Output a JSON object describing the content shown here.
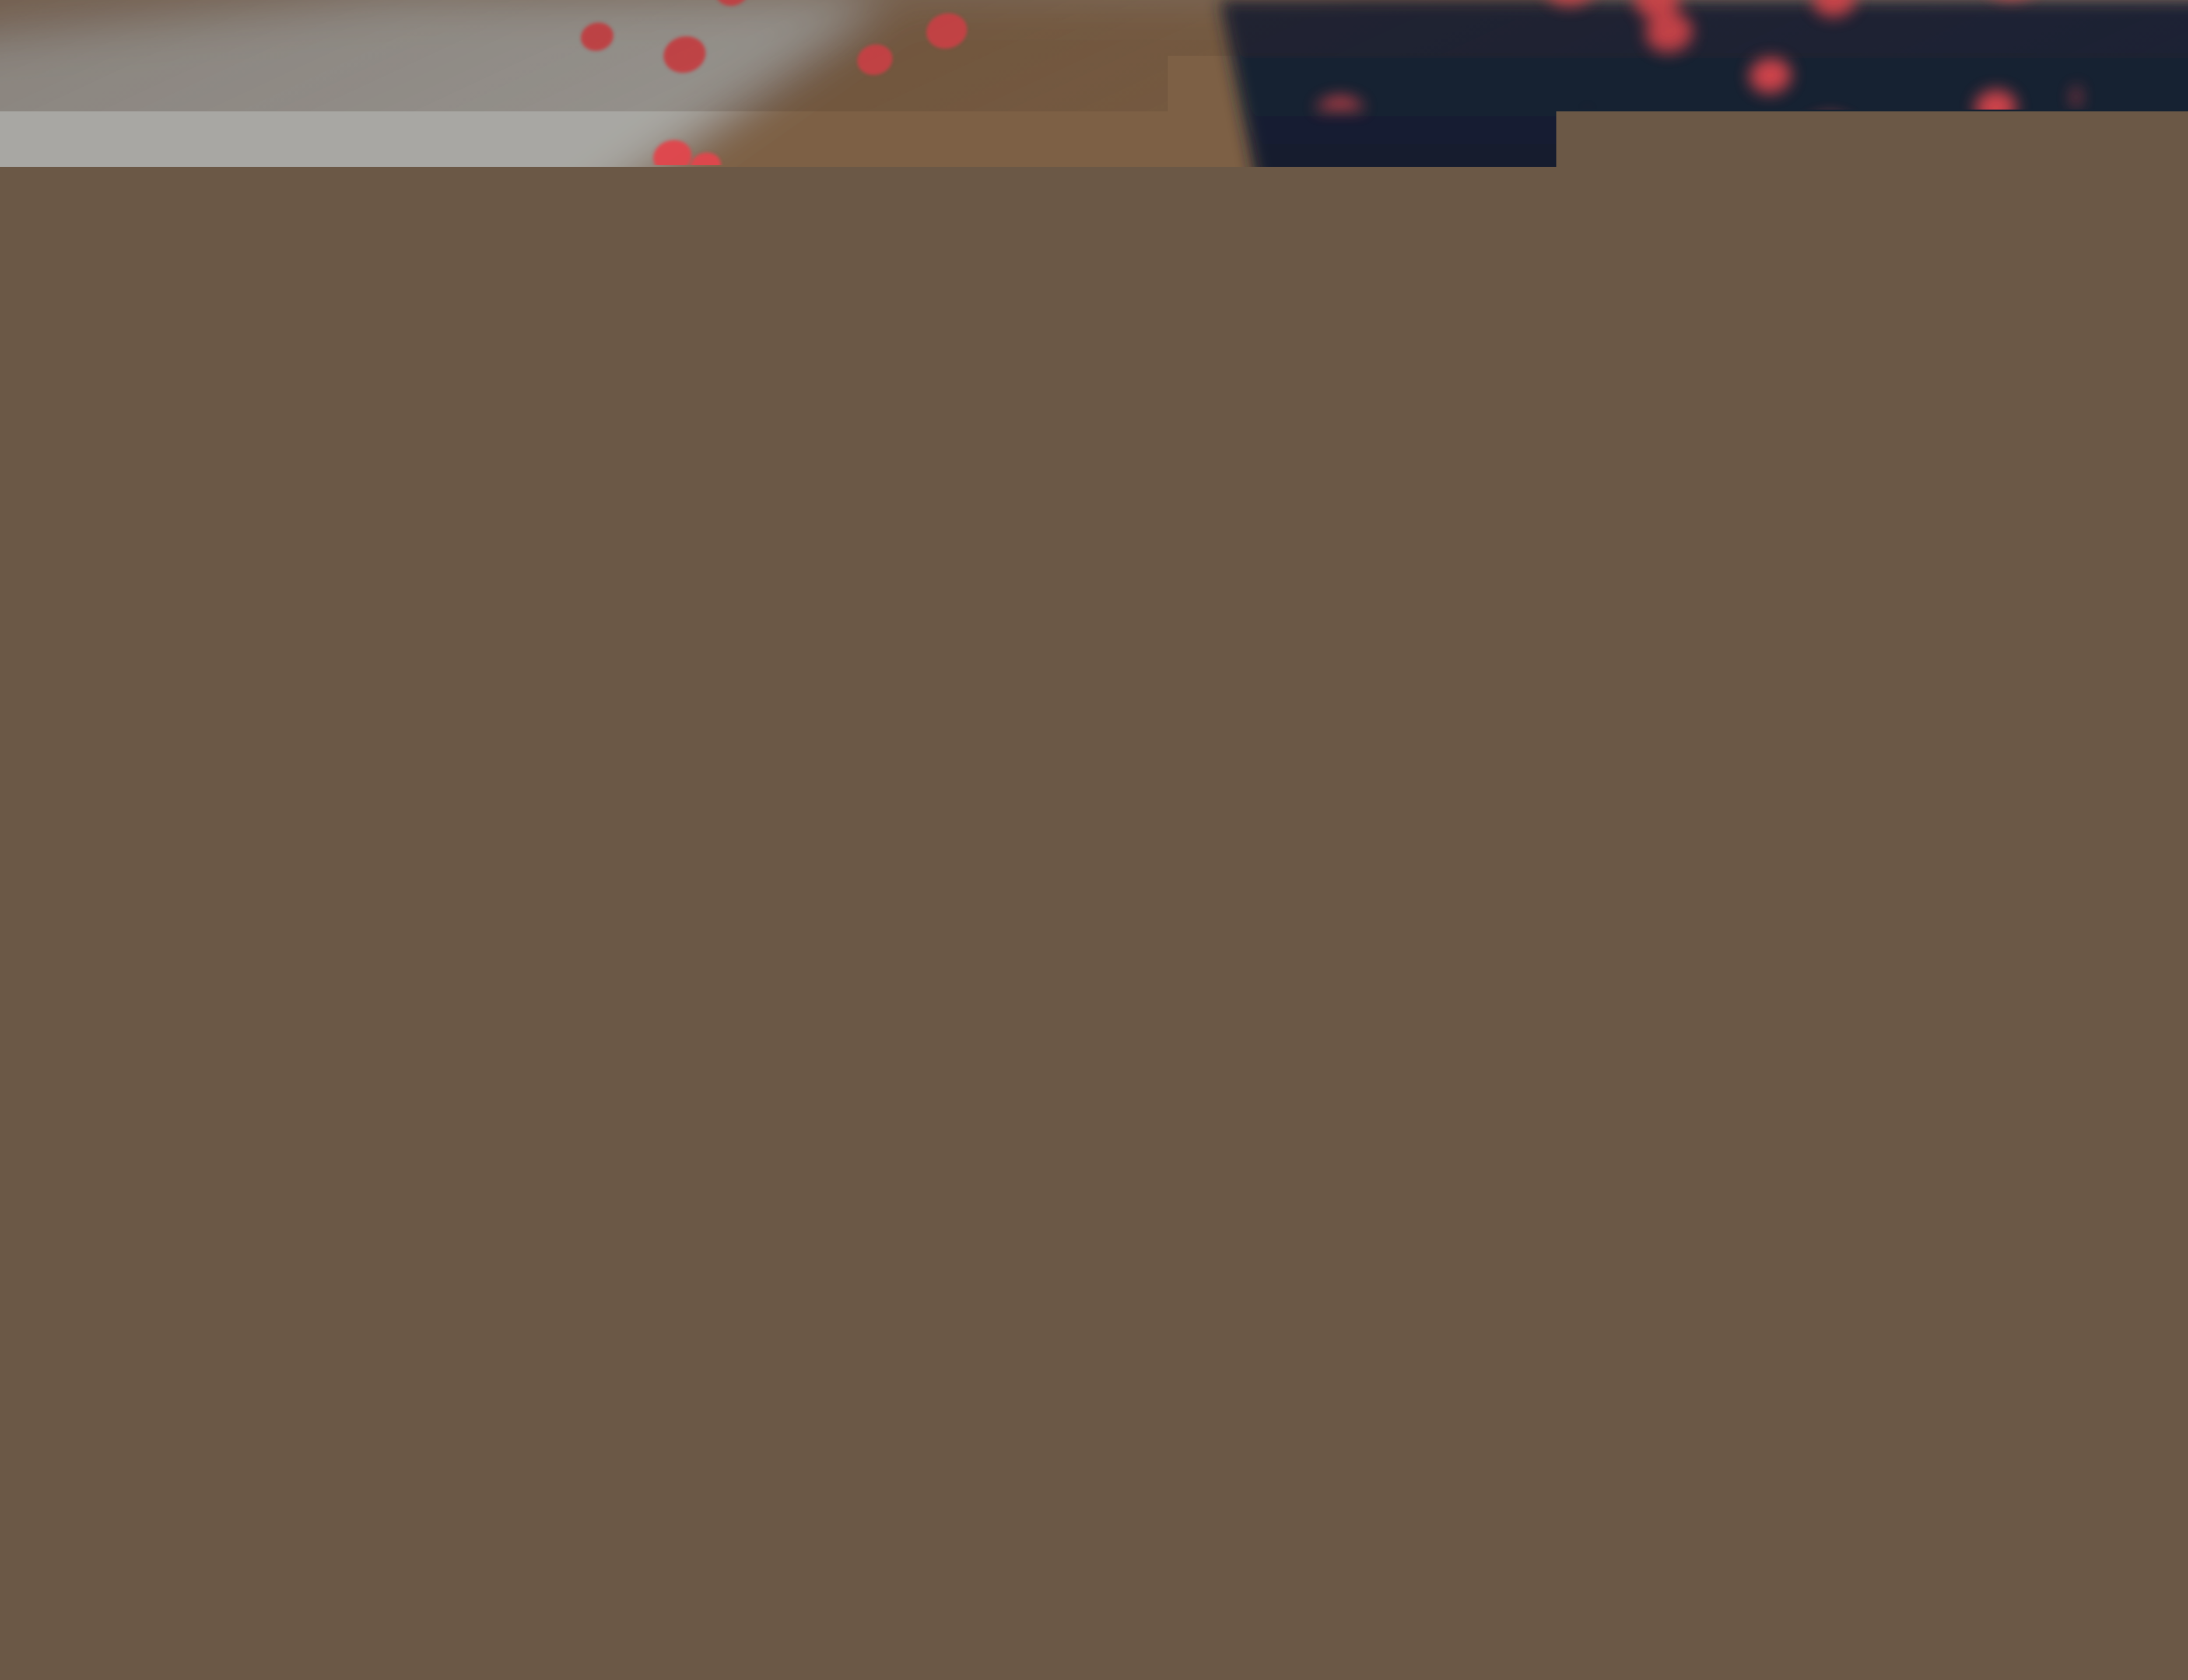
{
  "pencil": {
    "grade_label": "HB"
  },
  "blueprint": {
    "dimension_primary": "2,20",
    "dimension_secondary": "15",
    "door_symbol": "O"
  },
  "ruler": {
    "vertical_col_a": [
      "40",
      "50",
      "60",
      "70",
      "80",
      "90",
      "200",
      "10",
      "20",
      "30",
      "40",
      "50"
    ],
    "vertical_col_b": [
      "20",
      "10",
      "200",
      "90",
      "80",
      "70",
      "60",
      "50",
      "40",
      "30",
      "20",
      "10"
    ],
    "horizontal_row_top": [
      "60",
      "70",
      "80",
      "90",
      "200",
      "10",
      "20",
      "30",
      "40",
      "50",
      "60"
    ],
    "horizontal_row_bottom": [
      "20",
      "30",
      "40",
      "50",
      "60",
      "70",
      "80",
      "90",
      "100"
    ]
  },
  "colors": {
    "paper": "#f5e9e4",
    "plan_line": "#4a443e",
    "ruler_black": "#121216",
    "ruler_marking": "#e6e8df",
    "pencil_body": "#17171c",
    "pencil_wood": "#ecc29b",
    "shirt_navy": "#1a2233",
    "shirt_dot_red": "#e0474e",
    "skin": "#d9a98c",
    "mat_brown": "#41352a"
  }
}
